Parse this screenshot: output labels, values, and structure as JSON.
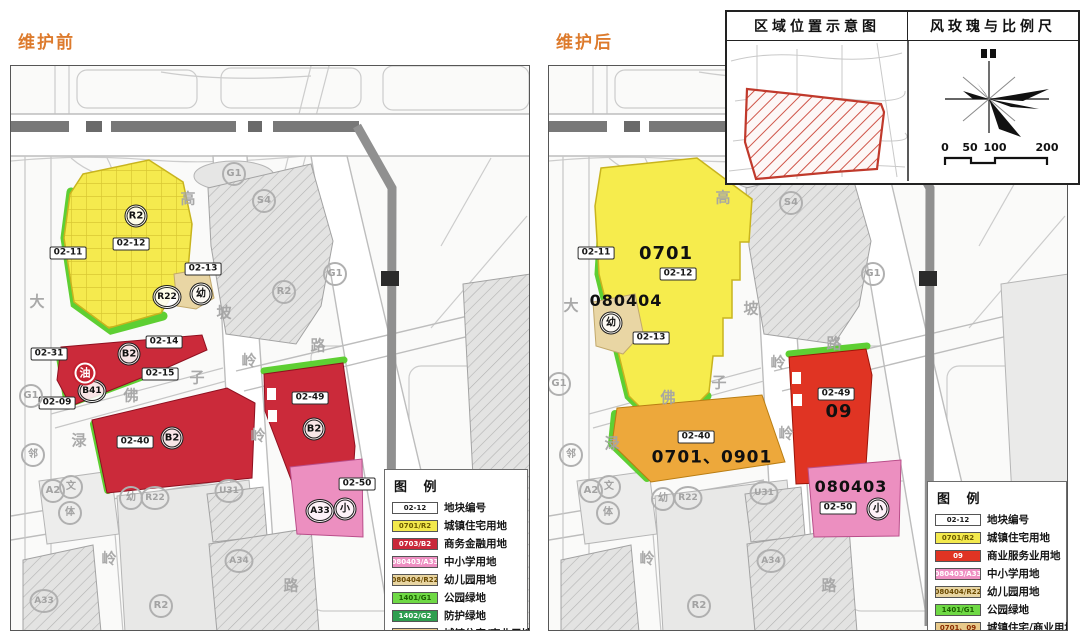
{
  "inset": {
    "left_title": "区域位置示意图",
    "right_title": "风玫瑰与比例尺",
    "scale": [
      "0",
      "50",
      "100",
      "200"
    ]
  },
  "maps": [
    {
      "title": "维护前",
      "legend_title": "图 例",
      "legend": [
        {
          "code": "02-12",
          "bg": "#ffffff",
          "fg": "#161616",
          "label": "地块编号"
        },
        {
          "code": "0701/R2",
          "bg": "#f3e94d",
          "fg": "#6b5a00",
          "label": "城镇住宅用地"
        },
        {
          "code": "0703/B2",
          "bg": "#c9283a",
          "fg": "#ffffff",
          "label": "商务金融用地"
        },
        {
          "code": "080403/A33",
          "bg": "#ee8fc2",
          "fg": "#ffffff",
          "label": "中小学用地"
        },
        {
          "code": "080404/R22",
          "bg": "#e8d5a2",
          "fg": "#6b4a00",
          "label": "幼儿园用地"
        },
        {
          "code": "1401/G1",
          "bg": "#6fd945",
          "fg": "#1c5e00",
          "label": "公园绿地"
        },
        {
          "code": "1402/G2",
          "bg": "#2e9e4f",
          "fg": "#ffffff",
          "label": "防护绿地"
        },
        {
          "code": "0701、09",
          "bg": "#e8c98a",
          "fg": "#8a2b00",
          "label": "城镇住宅/商业用地"
        }
      ],
      "labels": [
        {
          "t": "02-12",
          "k": "box",
          "x": 120,
          "y": 178
        },
        {
          "t": "02-11",
          "k": "box",
          "x": 57,
          "y": 187
        },
        {
          "t": "02-13",
          "k": "box",
          "x": 192,
          "y": 203
        },
        {
          "t": "02-31",
          "k": "box",
          "x": 38,
          "y": 288
        },
        {
          "t": "02-14",
          "k": "box",
          "x": 153,
          "y": 276
        },
        {
          "t": "02-15",
          "k": "box",
          "x": 149,
          "y": 308
        },
        {
          "t": "02-09",
          "k": "box",
          "x": 46,
          "y": 337
        },
        {
          "t": "02-40",
          "k": "box",
          "x": 124,
          "y": 376
        },
        {
          "t": "02-49",
          "k": "box",
          "x": 299,
          "y": 332
        },
        {
          "t": "02-50",
          "k": "box",
          "x": 346,
          "y": 418
        },
        {
          "t": "R2",
          "k": "circ",
          "x": 125,
          "y": 150
        },
        {
          "t": "R22",
          "k": "circ",
          "x": 156,
          "y": 231
        },
        {
          "t": "幼",
          "k": "circ",
          "x": 190,
          "y": 228
        },
        {
          "t": "B2",
          "k": "circ",
          "x": 118,
          "y": 288
        },
        {
          "t": "B41",
          "k": "circ",
          "x": 81,
          "y": 325
        },
        {
          "t": "B2",
          "k": "circ",
          "x": 161,
          "y": 372
        },
        {
          "t": "B2",
          "k": "circ",
          "x": 303,
          "y": 363
        },
        {
          "t": "A33",
          "k": "circ",
          "x": 309,
          "y": 445
        },
        {
          "t": "小",
          "k": "circ",
          "x": 334,
          "y": 443
        },
        {
          "t": "油",
          "k": "oil",
          "x": 74,
          "y": 307
        },
        {
          "t": "G1",
          "k": "ghost",
          "x": 223,
          "y": 108
        },
        {
          "t": "S4",
          "k": "ghost",
          "x": 253,
          "y": 135
        },
        {
          "t": "R2",
          "k": "ghost",
          "x": 273,
          "y": 226
        },
        {
          "t": "G1",
          "k": "ghost",
          "x": 20,
          "y": 330
        },
        {
          "t": "G1",
          "k": "ghost",
          "x": 324,
          "y": 208
        },
        {
          "t": "邻",
          "k": "ghost",
          "x": 22,
          "y": 389
        },
        {
          "t": "A2",
          "k": "ghost",
          "x": 42,
          "y": 425
        },
        {
          "t": "文",
          "k": "ghost",
          "x": 60,
          "y": 421
        },
        {
          "t": "体",
          "k": "ghost",
          "x": 59,
          "y": 447
        },
        {
          "t": "幼",
          "k": "ghost",
          "x": 120,
          "y": 432
        },
        {
          "t": "R22",
          "k": "ghost",
          "x": 144,
          "y": 432
        },
        {
          "t": "U31",
          "k": "ghost",
          "x": 218,
          "y": 425
        },
        {
          "t": "A34",
          "k": "ghost",
          "x": 228,
          "y": 495
        },
        {
          "t": "R2",
          "k": "ghost",
          "x": 150,
          "y": 540
        },
        {
          "t": "A33",
          "k": "ghost",
          "x": 33,
          "y": 535
        },
        {
          "t": "高",
          "k": "road",
          "x": 177,
          "y": 133
        },
        {
          "t": "坡",
          "k": "road",
          "x": 213,
          "y": 247
        },
        {
          "t": "岭",
          "k": "road",
          "x": 247,
          "y": 370
        },
        {
          "t": "路",
          "k": "road",
          "x": 280,
          "y": 520
        },
        {
          "t": "佛",
          "k": "road",
          "x": 120,
          "y": 330
        },
        {
          "t": "子",
          "k": "road",
          "x": 186,
          "y": 312
        },
        {
          "t": "岭",
          "k": "road",
          "x": 238,
          "y": 295
        },
        {
          "t": "路",
          "k": "road",
          "x": 307,
          "y": 280
        },
        {
          "t": "大",
          "k": "road",
          "x": 26,
          "y": 236
        },
        {
          "t": "渌",
          "k": "road",
          "x": 68,
          "y": 375
        },
        {
          "t": "岭",
          "k": "road",
          "x": 98,
          "y": 493
        }
      ]
    },
    {
      "title": "维护后",
      "legend_title": "图 例",
      "legend": [
        {
          "code": "02-12",
          "bg": "#ffffff",
          "fg": "#161616",
          "label": "地块编号"
        },
        {
          "code": "0701/R2",
          "bg": "#f3e94d",
          "fg": "#6b5a00",
          "label": "城镇住宅用地"
        },
        {
          "code": "09",
          "bg": "#e03423",
          "fg": "#ffffff",
          "label": "商业服务业用地"
        },
        {
          "code": "080403/A33",
          "bg": "#ee8fc2",
          "fg": "#ffffff",
          "label": "中小学用地"
        },
        {
          "code": "080404/R22",
          "bg": "#e8d5a2",
          "fg": "#6b4a00",
          "label": "幼儿园用地"
        },
        {
          "code": "1401/G1",
          "bg": "#6fd945",
          "fg": "#1c5e00",
          "label": "公园绿地"
        },
        {
          "code": "0701、09",
          "bg": "#e8c98a",
          "fg": "#8a2b00",
          "label": "城镇住宅/商业用地"
        }
      ],
      "labels": [
        {
          "t": "02-11",
          "k": "box",
          "x": 47,
          "y": 187
        },
        {
          "t": "02-12",
          "k": "box",
          "x": 129,
          "y": 208
        },
        {
          "t": "02-13",
          "k": "box",
          "x": 102,
          "y": 272
        },
        {
          "t": "02-40",
          "k": "box",
          "x": 147,
          "y": 371
        },
        {
          "t": "02-49",
          "k": "box",
          "x": 287,
          "y": 328
        },
        {
          "t": "02-50",
          "k": "box",
          "x": 289,
          "y": 442
        },
        {
          "t": "0701",
          "k": "ztext",
          "fs": 18,
          "x": 117,
          "y": 188
        },
        {
          "t": "080404",
          "k": "ztext",
          "fs": 16,
          "x": 77,
          "y": 235
        },
        {
          "t": "0701、0901",
          "k": "ztext",
          "fs": 17,
          "x": 163,
          "y": 392
        },
        {
          "t": "09",
          "k": "ztext",
          "fs": 18,
          "x": 290,
          "y": 346
        },
        {
          "t": "080403",
          "k": "ztext",
          "fs": 16,
          "x": 302,
          "y": 421
        },
        {
          "t": "幼",
          "k": "circ",
          "x": 62,
          "y": 257
        },
        {
          "t": "小",
          "k": "circ",
          "x": 329,
          "y": 443
        },
        {
          "t": "S4",
          "k": "ghost",
          "x": 242,
          "y": 137
        },
        {
          "t": "G1",
          "k": "ghost",
          "x": 10,
          "y": 318
        },
        {
          "t": "G1",
          "k": "ghost",
          "x": 324,
          "y": 208
        },
        {
          "t": "幼",
          "k": "ghost",
          "x": 114,
          "y": 433
        },
        {
          "t": "R22",
          "k": "ghost",
          "x": 139,
          "y": 432
        },
        {
          "t": "U31",
          "k": "ghost",
          "x": 215,
          "y": 427
        },
        {
          "t": "A34",
          "k": "ghost",
          "x": 222,
          "y": 495
        },
        {
          "t": "A2",
          "k": "ghost",
          "x": 42,
          "y": 425
        },
        {
          "t": "文",
          "k": "ghost",
          "x": 60,
          "y": 421
        },
        {
          "t": "体",
          "k": "ghost",
          "x": 59,
          "y": 447
        },
        {
          "t": "邻",
          "k": "ghost",
          "x": 22,
          "y": 389
        },
        {
          "t": "R2",
          "k": "ghost",
          "x": 150,
          "y": 540
        },
        {
          "t": "高",
          "k": "road",
          "x": 174,
          "y": 132
        },
        {
          "t": "坡",
          "k": "road",
          "x": 202,
          "y": 243
        },
        {
          "t": "岭",
          "k": "road",
          "x": 237,
          "y": 368
        },
        {
          "t": "大",
          "k": "road",
          "x": 22,
          "y": 240
        },
        {
          "t": "佛",
          "k": "road",
          "x": 119,
          "y": 332
        },
        {
          "t": "子",
          "k": "road",
          "x": 170,
          "y": 317
        },
        {
          "t": "岭",
          "k": "road",
          "x": 229,
          "y": 297
        },
        {
          "t": "路",
          "k": "road",
          "x": 285,
          "y": 278
        },
        {
          "t": "渌",
          "k": "road",
          "x": 63,
          "y": 378
        },
        {
          "t": "岭",
          "k": "road",
          "x": 98,
          "y": 493
        },
        {
          "t": "路",
          "k": "road",
          "x": 280,
          "y": 520
        }
      ]
    }
  ]
}
